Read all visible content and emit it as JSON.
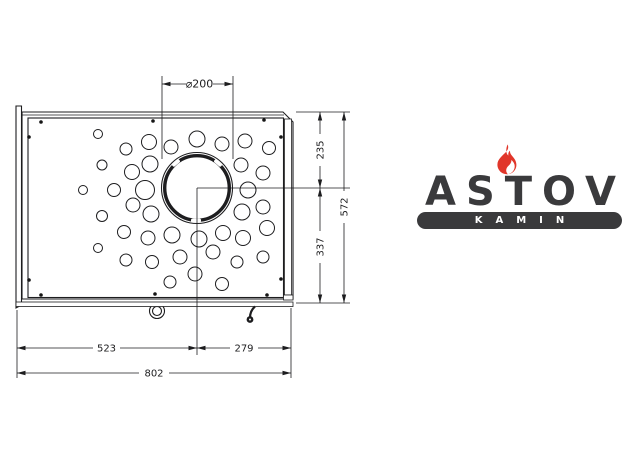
{
  "logo": {
    "brand": "ASTOV",
    "sub": "KAMIN",
    "colors": {
      "dark": "#3a3a3c",
      "flame_red": "#e1362a"
    }
  },
  "drawing": {
    "title_meaning": "kamin top plate, plan view",
    "ink_color": "#1d1d1f",
    "dims": {
      "diameter_label": "⌀200",
      "right_upper": "235",
      "right_lower": "337",
      "right_total": "572",
      "bottom_left": "523",
      "bottom_right": "279",
      "bottom_total": "802"
    },
    "flue_collar": {
      "center_x": 197,
      "center_y": 188,
      "outer_r": 35.5
    },
    "holes": [
      [
        98,
        134,
        4.5
      ],
      [
        126,
        149,
        6
      ],
      [
        149,
        142,
        7.5
      ],
      [
        171,
        147,
        7
      ],
      [
        197,
        139,
        8
      ],
      [
        222,
        144,
        7
      ],
      [
        245,
        141,
        7
      ],
      [
        269,
        148,
        6.5
      ],
      [
        102,
        165,
        5
      ],
      [
        132,
        172,
        7.5
      ],
      [
        150,
        164,
        8
      ],
      [
        83,
        190,
        4.5
      ],
      [
        114,
        190,
        6.5
      ],
      [
        145,
        190,
        9.5
      ],
      [
        241,
        165,
        7
      ],
      [
        263,
        173,
        7
      ],
      [
        248,
        190,
        8
      ],
      [
        133,
        205,
        7
      ],
      [
        102,
        216,
        5.5
      ],
      [
        151,
        214,
        8
      ],
      [
        124,
        232,
        6.5
      ],
      [
        148,
        238,
        7
      ],
      [
        98,
        248,
        4.5
      ],
      [
        126,
        260,
        6
      ],
      [
        152,
        262,
        6.5
      ],
      [
        263,
        207,
        7
      ],
      [
        242,
        212,
        8
      ],
      [
        267,
        228,
        7.5
      ],
      [
        223,
        233,
        7.5
      ],
      [
        199,
        239,
        8
      ],
      [
        172,
        235,
        8
      ],
      [
        243,
        238,
        7.5
      ],
      [
        180,
        257,
        7
      ],
      [
        213,
        252,
        7
      ],
      [
        237,
        262,
        6
      ],
      [
        263,
        257,
        6
      ],
      [
        195,
        274,
        7
      ],
      [
        170,
        282,
        6
      ],
      [
        222,
        284,
        6.5
      ]
    ],
    "screws": [
      [
        41,
        122
      ],
      [
        153,
        121
      ],
      [
        264,
        120
      ],
      [
        29,
        137
      ],
      [
        281,
        137
      ],
      [
        29,
        280
      ],
      [
        281,
        279
      ],
      [
        41,
        295
      ],
      [
        155,
        294
      ],
      [
        267,
        295
      ]
    ]
  }
}
